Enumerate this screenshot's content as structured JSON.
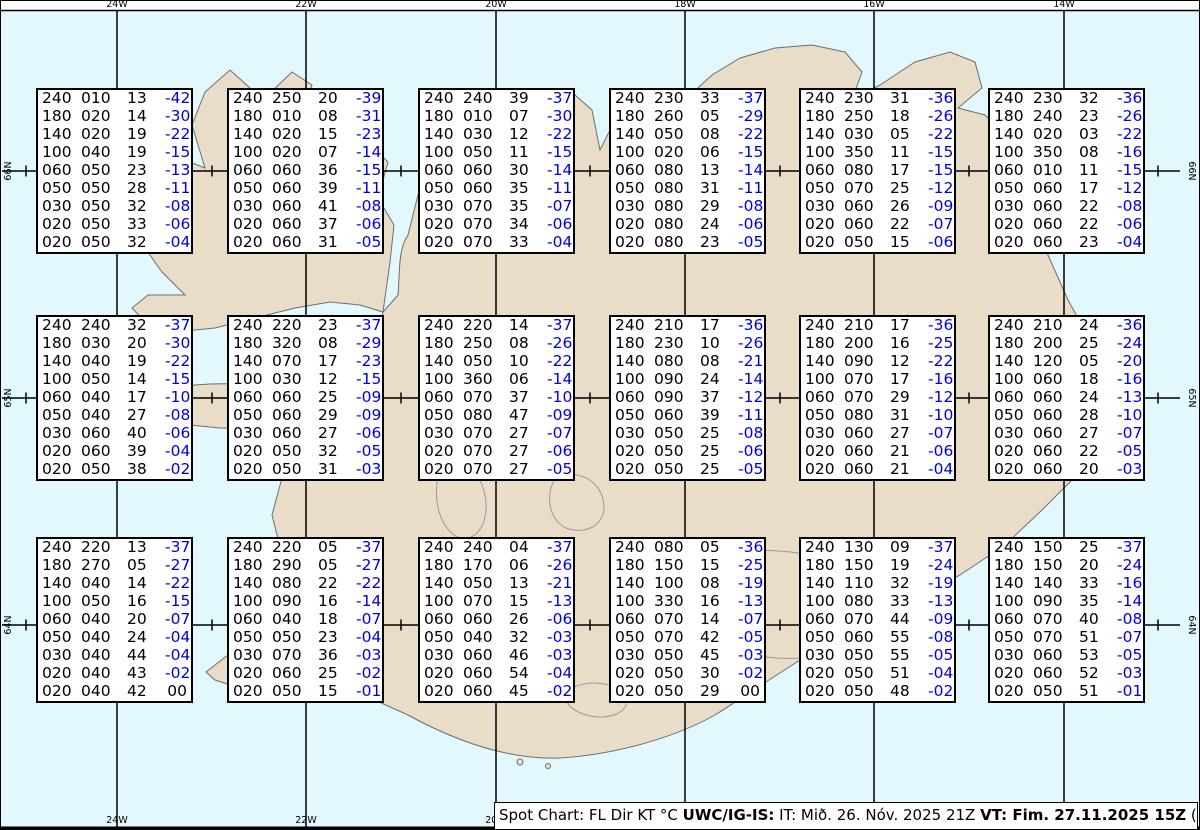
{
  "title": "Spot Chart Iceland winds and temperatures aloft",
  "columns": [
    "FL",
    "Dir",
    "KT",
    "°C"
  ],
  "caption": {
    "prefix": "Spot Chart: FL Dir KT °C ",
    "bold1": "UWC/IG-IS:",
    "mid": " IT: Mið. 26. Nóv. 2025 21Z ",
    "bold2": "VT: Fim. 27.11.2025 15Z",
    "suffix": " (+18 h)"
  },
  "colors": {
    "water": "#e2f8fc",
    "land": "#e9dcc8",
    "coast": "#6e6e6e",
    "glacier_contour": "#9a9a9a",
    "temp_blue": "#0000dd",
    "frame": "#000000"
  },
  "grid": {
    "meridians": [
      {
        "label": "24W",
        "x": 117
      },
      {
        "label": "22W",
        "x": 306
      },
      {
        "label": "20W",
        "x": 496
      },
      {
        "label": "18W",
        "x": 685
      },
      {
        "label": "16W",
        "x": 874
      },
      {
        "label": "14W",
        "x": 1064
      }
    ],
    "bottom_labels": [
      "24W",
      "22W",
      "20W"
    ],
    "parallels": [
      {
        "label": "66N",
        "y": 171
      },
      {
        "label": "65N",
        "y": 398
      },
      {
        "label": "64N",
        "y": 625
      }
    ],
    "minor_tick_x": [
      26,
      212,
      401,
      590,
      780,
      969,
      1158
    ],
    "frame_top_y": 10,
    "frame_bottom_y": 828
  },
  "layout": {
    "col_x": [
      36,
      227,
      418,
      609,
      799,
      988
    ],
    "row_y": [
      88,
      315,
      537
    ],
    "box_w": 157,
    "box_h": 166
  },
  "stations": [
    {
      "row": 0,
      "col": 0,
      "rows": [
        [
          "240",
          "010",
          "13",
          "-42"
        ],
        [
          "180",
          "020",
          "14",
          "-30"
        ],
        [
          "140",
          "020",
          "19",
          "-22"
        ],
        [
          "100",
          "040",
          "19",
          "-15"
        ],
        [
          "060",
          "050",
          "23",
          "-13"
        ],
        [
          "050",
          "050",
          "28",
          "-11"
        ],
        [
          "030",
          "050",
          "32",
          "-08"
        ],
        [
          "020",
          "050",
          "33",
          "-06"
        ],
        [
          "020",
          "050",
          "32",
          "-04"
        ]
      ]
    },
    {
      "row": 0,
      "col": 1,
      "rows": [
        [
          "240",
          "250",
          "20",
          "-39"
        ],
        [
          "180",
          "010",
          "08",
          "-31"
        ],
        [
          "140",
          "020",
          "15",
          "-23"
        ],
        [
          "100",
          "020",
          "07",
          "-14"
        ],
        [
          "060",
          "060",
          "36",
          "-15"
        ],
        [
          "050",
          "060",
          "39",
          "-11"
        ],
        [
          "030",
          "060",
          "41",
          "-08"
        ],
        [
          "020",
          "060",
          "37",
          "-06"
        ],
        [
          "020",
          "060",
          "31",
          "-05"
        ]
      ]
    },
    {
      "row": 0,
      "col": 2,
      "rows": [
        [
          "240",
          "240",
          "39",
          "-37"
        ],
        [
          "180",
          "010",
          "07",
          "-30"
        ],
        [
          "140",
          "030",
          "12",
          "-22"
        ],
        [
          "100",
          "050",
          "11",
          "-15"
        ],
        [
          "060",
          "060",
          "30",
          "-14"
        ],
        [
          "050",
          "060",
          "35",
          "-11"
        ],
        [
          "030",
          "070",
          "35",
          "-07"
        ],
        [
          "020",
          "070",
          "34",
          "-06"
        ],
        [
          "020",
          "070",
          "33",
          "-04"
        ]
      ]
    },
    {
      "row": 0,
      "col": 3,
      "rows": [
        [
          "240",
          "230",
          "33",
          "-37"
        ],
        [
          "180",
          "260",
          "05",
          "-29"
        ],
        [
          "140",
          "050",
          "08",
          "-22"
        ],
        [
          "100",
          "020",
          "06",
          "-15"
        ],
        [
          "060",
          "080",
          "13",
          "-14"
        ],
        [
          "050",
          "080",
          "31",
          "-11"
        ],
        [
          "030",
          "080",
          "29",
          "-08"
        ],
        [
          "020",
          "080",
          "24",
          "-06"
        ],
        [
          "020",
          "080",
          "23",
          "-05"
        ]
      ]
    },
    {
      "row": 0,
      "col": 4,
      "rows": [
        [
          "240",
          "230",
          "31",
          "-36"
        ],
        [
          "180",
          "250",
          "18",
          "-26"
        ],
        [
          "140",
          "030",
          "05",
          "-22"
        ],
        [
          "100",
          "350",
          "11",
          "-15"
        ],
        [
          "060",
          "080",
          "17",
          "-15"
        ],
        [
          "050",
          "070",
          "25",
          "-12"
        ],
        [
          "030",
          "060",
          "26",
          "-09"
        ],
        [
          "020",
          "060",
          "22",
          "-07"
        ],
        [
          "020",
          "050",
          "15",
          "-06"
        ]
      ]
    },
    {
      "row": 0,
      "col": 5,
      "rows": [
        [
          "240",
          "230",
          "32",
          "-36"
        ],
        [
          "180",
          "240",
          "23",
          "-26"
        ],
        [
          "140",
          "020",
          "03",
          "-22"
        ],
        [
          "100",
          "350",
          "08",
          "-16"
        ],
        [
          "060",
          "010",
          "11",
          "-15"
        ],
        [
          "050",
          "060",
          "17",
          "-12"
        ],
        [
          "030",
          "060",
          "22",
          "-08"
        ],
        [
          "020",
          "060",
          "22",
          "-06"
        ],
        [
          "020",
          "060",
          "23",
          "-04"
        ]
      ]
    },
    {
      "row": 1,
      "col": 0,
      "rows": [
        [
          "240",
          "240",
          "32",
          "-37"
        ],
        [
          "180",
          "030",
          "20",
          "-30"
        ],
        [
          "140",
          "040",
          "19",
          "-22"
        ],
        [
          "100",
          "050",
          "14",
          "-15"
        ],
        [
          "060",
          "040",
          "17",
          "-10"
        ],
        [
          "050",
          "040",
          "27",
          "-08"
        ],
        [
          "030",
          "060",
          "40",
          "-06"
        ],
        [
          "020",
          "060",
          "39",
          "-04"
        ],
        [
          "020",
          "050",
          "38",
          "-02"
        ]
      ]
    },
    {
      "row": 1,
      "col": 1,
      "rows": [
        [
          "240",
          "220",
          "23",
          "-37"
        ],
        [
          "180",
          "320",
          "08",
          "-29"
        ],
        [
          "140",
          "070",
          "17",
          "-23"
        ],
        [
          "100",
          "030",
          "12",
          "-15"
        ],
        [
          "060",
          "060",
          "25",
          "-09"
        ],
        [
          "050",
          "060",
          "29",
          "-09"
        ],
        [
          "030",
          "060",
          "27",
          "-06"
        ],
        [
          "020",
          "050",
          "32",
          "-05"
        ],
        [
          "020",
          "050",
          "31",
          "-03"
        ]
      ]
    },
    {
      "row": 1,
      "col": 2,
      "rows": [
        [
          "240",
          "220",
          "14",
          "-37"
        ],
        [
          "180",
          "250",
          "08",
          "-26"
        ],
        [
          "140",
          "050",
          "10",
          "-22"
        ],
        [
          "100",
          "360",
          "06",
          "-14"
        ],
        [
          "060",
          "070",
          "37",
          "-10"
        ],
        [
          "050",
          "080",
          "47",
          "-09"
        ],
        [
          "030",
          "070",
          "27",
          "-07"
        ],
        [
          "020",
          "070",
          "27",
          "-06"
        ],
        [
          "020",
          "070",
          "27",
          "-05"
        ]
      ]
    },
    {
      "row": 1,
      "col": 3,
      "rows": [
        [
          "240",
          "210",
          "17",
          "-36"
        ],
        [
          "180",
          "230",
          "10",
          "-26"
        ],
        [
          "140",
          "080",
          "08",
          "-21"
        ],
        [
          "100",
          "090",
          "24",
          "-14"
        ],
        [
          "060",
          "090",
          "37",
          "-12"
        ],
        [
          "050",
          "060",
          "39",
          "-11"
        ],
        [
          "030",
          "050",
          "25",
          "-08"
        ],
        [
          "020",
          "050",
          "25",
          "-06"
        ],
        [
          "020",
          "050",
          "25",
          "-05"
        ]
      ]
    },
    {
      "row": 1,
      "col": 4,
      "rows": [
        [
          "240",
          "210",
          "17",
          "-36"
        ],
        [
          "180",
          "200",
          "16",
          "-25"
        ],
        [
          "140",
          "090",
          "12",
          "-22"
        ],
        [
          "100",
          "070",
          "17",
          "-16"
        ],
        [
          "060",
          "070",
          "29",
          "-12"
        ],
        [
          "050",
          "080",
          "31",
          "-10"
        ],
        [
          "030",
          "060",
          "27",
          "-07"
        ],
        [
          "020",
          "060",
          "21",
          "-06"
        ],
        [
          "020",
          "060",
          "21",
          "-04"
        ]
      ]
    },
    {
      "row": 1,
      "col": 5,
      "rows": [
        [
          "240",
          "210",
          "24",
          "-36"
        ],
        [
          "180",
          "200",
          "25",
          "-24"
        ],
        [
          "140",
          "120",
          "05",
          "-20"
        ],
        [
          "100",
          "060",
          "18",
          "-16"
        ],
        [
          "060",
          "060",
          "24",
          "-13"
        ],
        [
          "050",
          "060",
          "28",
          "-10"
        ],
        [
          "030",
          "060",
          "27",
          "-07"
        ],
        [
          "020",
          "060",
          "22",
          "-05"
        ],
        [
          "020",
          "060",
          "20",
          "-03"
        ]
      ]
    },
    {
      "row": 2,
      "col": 0,
      "rows": [
        [
          "240",
          "220",
          "13",
          "-37"
        ],
        [
          "180",
          "270",
          "05",
          "-27"
        ],
        [
          "140",
          "040",
          "14",
          "-22"
        ],
        [
          "100",
          "050",
          "16",
          "-15"
        ],
        [
          "060",
          "040",
          "20",
          "-07"
        ],
        [
          "050",
          "040",
          "24",
          "-04"
        ],
        [
          "030",
          "040",
          "44",
          "-04"
        ],
        [
          "020",
          "040",
          "43",
          "-02"
        ],
        [
          "020",
          "040",
          "42",
          "00"
        ]
      ]
    },
    {
      "row": 2,
      "col": 1,
      "rows": [
        [
          "240",
          "220",
          "05",
          "-37"
        ],
        [
          "180",
          "290",
          "05",
          "-27"
        ],
        [
          "140",
          "080",
          "22",
          "-22"
        ],
        [
          "100",
          "090",
          "16",
          "-14"
        ],
        [
          "060",
          "040",
          "18",
          "-07"
        ],
        [
          "050",
          "050",
          "23",
          "-04"
        ],
        [
          "030",
          "070",
          "36",
          "-03"
        ],
        [
          "020",
          "060",
          "25",
          "-02"
        ],
        [
          "020",
          "050",
          "15",
          "-01"
        ]
      ]
    },
    {
      "row": 2,
      "col": 2,
      "rows": [
        [
          "240",
          "240",
          "04",
          "-37"
        ],
        [
          "180",
          "170",
          "06",
          "-26"
        ],
        [
          "140",
          "050",
          "13",
          "-21"
        ],
        [
          "100",
          "070",
          "15",
          "-13"
        ],
        [
          "060",
          "060",
          "26",
          "-06"
        ],
        [
          "050",
          "040",
          "32",
          "-03"
        ],
        [
          "030",
          "060",
          "46",
          "-03"
        ],
        [
          "020",
          "060",
          "54",
          "-04"
        ],
        [
          "020",
          "060",
          "45",
          "-02"
        ]
      ]
    },
    {
      "row": 2,
      "col": 3,
      "rows": [
        [
          "240",
          "080",
          "05",
          "-36"
        ],
        [
          "180",
          "150",
          "15",
          "-25"
        ],
        [
          "140",
          "100",
          "08",
          "-19"
        ],
        [
          "100",
          "330",
          "16",
          "-13"
        ],
        [
          "060",
          "070",
          "14",
          "-07"
        ],
        [
          "050",
          "070",
          "42",
          "-05"
        ],
        [
          "030",
          "050",
          "45",
          "-03"
        ],
        [
          "020",
          "050",
          "30",
          "-02"
        ],
        [
          "020",
          "050",
          "29",
          "00"
        ]
      ]
    },
    {
      "row": 2,
      "col": 4,
      "rows": [
        [
          "240",
          "130",
          "09",
          "-37"
        ],
        [
          "180",
          "150",
          "19",
          "-24"
        ],
        [
          "140",
          "110",
          "32",
          "-19"
        ],
        [
          "100",
          "080",
          "33",
          "-13"
        ],
        [
          "060",
          "070",
          "44",
          "-09"
        ],
        [
          "050",
          "060",
          "55",
          "-08"
        ],
        [
          "030",
          "050",
          "55",
          "-05"
        ],
        [
          "020",
          "050",
          "51",
          "-04"
        ],
        [
          "020",
          "050",
          "48",
          "-02"
        ]
      ]
    },
    {
      "row": 2,
      "col": 5,
      "rows": [
        [
          "240",
          "150",
          "25",
          "-37"
        ],
        [
          "180",
          "150",
          "20",
          "-24"
        ],
        [
          "140",
          "140",
          "33",
          "-16"
        ],
        [
          "100",
          "090",
          "35",
          "-14"
        ],
        [
          "060",
          "070",
          "40",
          "-08"
        ],
        [
          "050",
          "070",
          "51",
          "-07"
        ],
        [
          "030",
          "060",
          "53",
          "-05"
        ],
        [
          "020",
          "060",
          "52",
          "-03"
        ],
        [
          "020",
          "050",
          "51",
          "-01"
        ]
      ]
    }
  ]
}
